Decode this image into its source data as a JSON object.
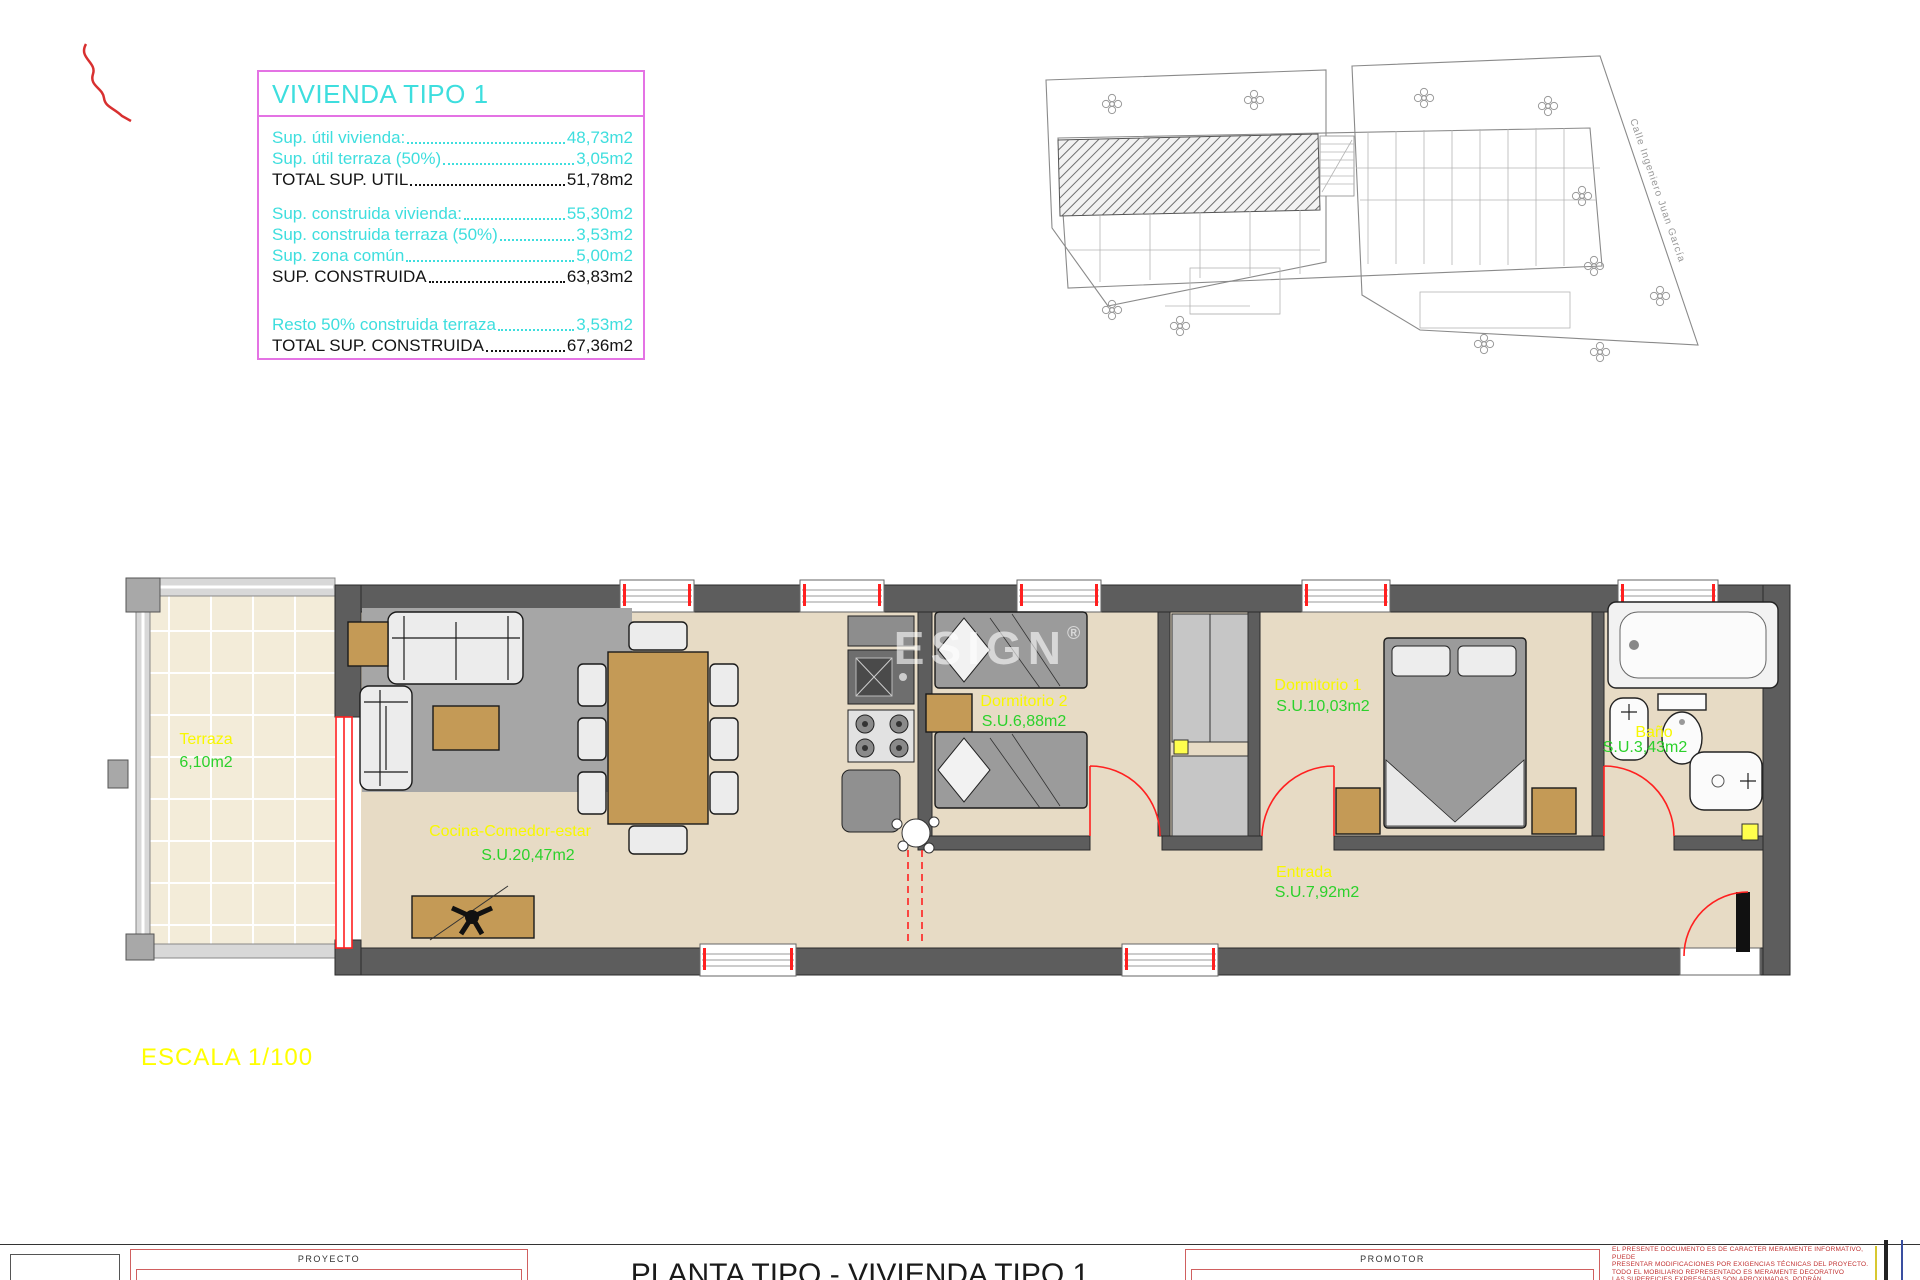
{
  "info_box": {
    "title": "VIVIENDA TIPO 1",
    "groups": [
      {
        "rows": [
          {
            "label": "Sup. útil vivienda:",
            "value": "48,73m2"
          },
          {
            "label": "Sup. útil terraza (50%)",
            "value": "3,05m2"
          },
          {
            "label": "TOTAL SUP. UTIL",
            "value": "51,78m2"
          }
        ]
      },
      {
        "rows": [
          {
            "label": "Sup. construida vivienda:",
            "value": "55,30m2"
          },
          {
            "label": "Sup. construida terraza (50%)",
            "value": "3,53m2"
          },
          {
            "label": "Sup. zona común ",
            "value": "5,00m2"
          },
          {
            "label": "SUP. CONSTRUIDA",
            "value": "63,83m2"
          }
        ]
      },
      {
        "rows": [
          {
            "label": "Resto 50% construida terraza",
            "value": "3,53m2"
          },
          {
            "label": "TOTAL SUP. CONSTRUIDA",
            "value": "67,36m2"
          }
        ]
      }
    ]
  },
  "site_plan": {
    "street_label": "Calle  Ingeniero Juan García"
  },
  "plan": {
    "rooms": [
      {
        "name": "Terraza",
        "area": "6,10m2"
      },
      {
        "name": "Cocina-Comedor-estar",
        "area": "S.U.20,47m2"
      },
      {
        "name": "Dormitorio 2",
        "area": "S.U.6,88m2"
      },
      {
        "name": "Dormitorio 1",
        "area": "S.U.10,03m2"
      },
      {
        "name": "Baño",
        "area": "S.U.3,43m2"
      },
      {
        "name": "Entrada",
        "area": "S.U.7,92m2"
      }
    ],
    "watermark_text": "ESIGN",
    "watermark_mark": "®"
  },
  "scale_label": "ESCALA 1/100",
  "title_block": {
    "proyecto_label": "PROYECTO",
    "promotor_label": "PROMOTOR",
    "title": "PLANTA TIPO - VIVIENDA TIPO 1",
    "disclaimer": [
      "EL PRESENTE DOCUMENTO ES DE CARÁCTER MERAMENTE INFORMATIVO, PUEDE",
      "PRESENTAR MODIFICACIONES POR EXIGENCIAS TÉCNICAS DEL PROYECTO.",
      "TODO EL MOBILIARIO REPRESENTADO ES MERAMENTE DECORATIVO",
      "LAS SUPERFICIES EXPRESADAS SON APROXIMADAS, PODRÁN"
    ]
  }
}
